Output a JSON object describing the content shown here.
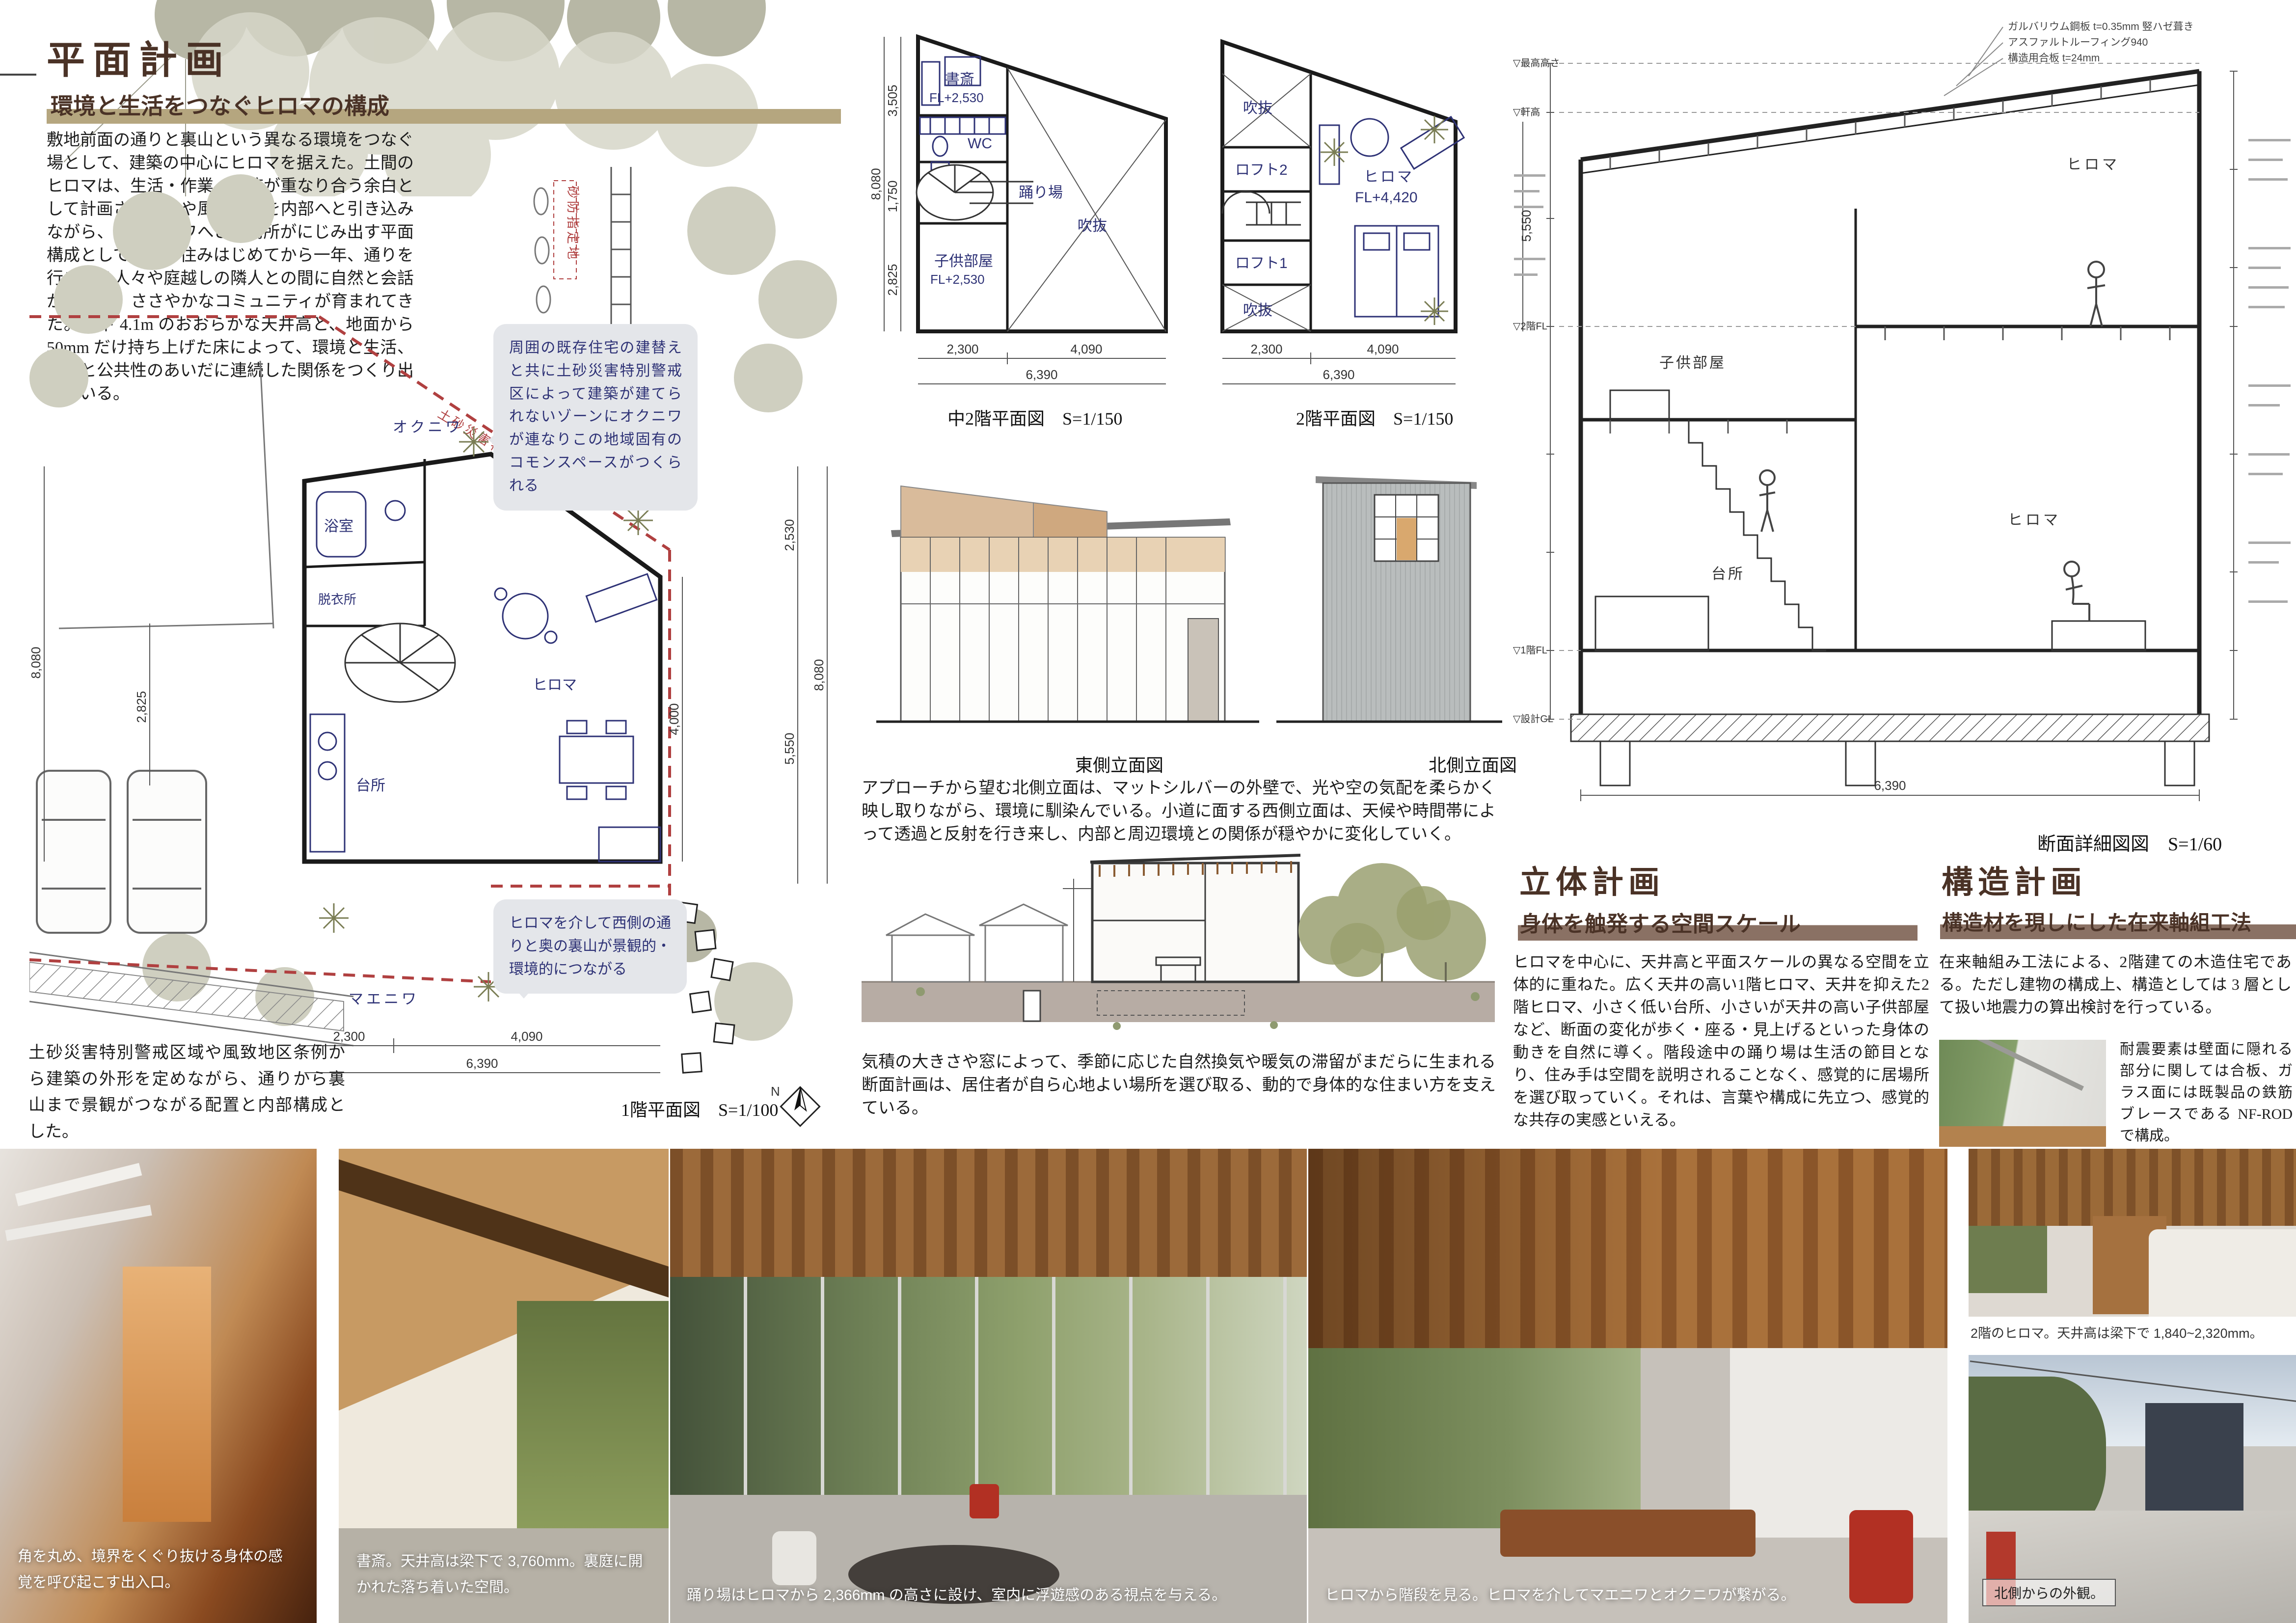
{
  "colors": {
    "accent_brown": "#4a3226",
    "tan_bar": "#b5a67f",
    "brown_bar": "#8a7164",
    "navy": "#2e3276",
    "hazard_red": "#b04040",
    "bubble_gray": "#e4e6ea"
  },
  "left": {
    "title": "平面計画",
    "subtitle": "環境と生活をつなぐヒロマの構成",
    "body": "敷地前面の通りと裏山という異なる環境をつなぐ場として、建築の中心にヒロマを据えた。土間のヒロマは、生活・作業・交流が重なり合う余白として計画され、光や風、気配を内部へと引き込みながら、東西のニワへと居場所がにじみ出す平面構成としている。住みはじめてから一年、通りを行き交う人々や庭越しの隣人との間に自然と会話が生まれ、ささやかなコミュニティが育まれてきた。梁下 4.1m のおおらかな天井高と、地面から 50mm だけ持ち上げた床によって、環境と生活、私性と公共性のあいだに連続した関係をつくり出している。",
    "callout_top": "周囲の既存住宅の建替えと共に土砂災害特別警戒区によって建築が建てられないゾーンにオクニワが連なりこの地域固有のコモンスペースがつくられる",
    "callout_bottom": "ヒロマを介して西側の通りと奥の裏山が景観的・環境的につながる",
    "note": "土砂災害特別警戒区域や風致地区条例から建築の外形を定めながら、通りから裏山まで景観がつながる配置と内部構成とした。",
    "plan_label": "1階平面図　S=1/100",
    "north_label": "N",
    "site": {
      "room_bath": "浴室",
      "room_dressing": "脱衣所",
      "room_hiroma": "ヒロマ",
      "room_kitchen": "台所",
      "garden_back": "オクニワ",
      "garden_front": "マエニワ",
      "hazard_line": "土砂災害特別警戒区域",
      "hazard_box": "砂防指定地",
      "dim_left_a": "8,080",
      "dim_left_b": "2,825",
      "dim_right_a": "2,530",
      "dim_right_b": "8,080",
      "dim_right_c": "5,550",
      "dim_right_d": "4,000",
      "dim_bottom_a": "2,300",
      "dim_bottom_b": "4,090",
      "dim_bottom_c": "6,390"
    }
  },
  "mid": {
    "plan_a": {
      "label": "中2階平面図　S=1/150",
      "study": "書斎",
      "study_fl": "FL+2,530",
      "wc": "WC",
      "landing": "踊り場",
      "void": "吹抜",
      "child": "子供部屋",
      "child_fl": "FL+2,530",
      "dim_v_total": "8,080",
      "dim_v1": "3,505",
      "dim_v2": "1,750",
      "dim_v3": "2,825",
      "dim_b1": "2,300",
      "dim_b2": "4,090",
      "dim_b_total": "6,390"
    },
    "plan_b": {
      "label": "2階平面図　S=1/150",
      "void_top": "吹抜",
      "loft2": "ロフト2",
      "loft1": "ロフト1",
      "void_bottom": "吹抜",
      "hiroma": "ヒロマ",
      "hiroma_fl": "FL+4,420",
      "dim_right": "5,550",
      "dim_b1": "2,300",
      "dim_b2": "4,090",
      "dim_b_total": "6,390"
    },
    "elev_east": "東側立面図",
    "elev_north": "北側立面図",
    "elev_text": "アプローチから望む北側立面は、マットシルバーの外壁で、光や空の気配を柔らかく映し取りながら、環境に馴染んでいる。小道に面する西側立面は、天候や時間帯によって透過と反射を行き来し、内部と周辺環境との関係が穏やかに変化していく。",
    "section_text": "気積の大きさや窓によって、季節に応じた自然換気や暖気の滞留がまだらに生まれる断面計画は、居住者が自ら心地よい場所を選び取る、動的で身体的な住まい方を支えている。"
  },
  "right": {
    "detail_label": "断面詳細図図　S=1/60",
    "room_hiroma_2f": "ヒロマ",
    "room_child": "子供部屋",
    "room_hiroma_1f": "ヒロマ",
    "room_kitchen": "台所",
    "lv_top": "▽最高高さ",
    "lv_eave": "▽軒高",
    "lv_2f": "▽2階FL",
    "lv_1f": "▽1階FL",
    "lv_gl": "▽設計GL",
    "ann_1": "ガルバリウム鋼板 t=0.35mm 竪ハゼ葺き",
    "ann_2": "アスファルトルーフィング940",
    "ann_3": "構造用合板 t=24mm",
    "dim_bottom": "6,390",
    "solid_title": "立体計画",
    "solid_subtitle": "身体を触発する空間スケール",
    "solid_body": "ヒロマを中心に、天井高と平面スケールの異なる空間を立体的に重ねた。広く天井の高い1階ヒロマ、天井を抑えた2階ヒロマ、小さく低い台所、小さいが天井の高い子供部屋など、断面の変化が歩く・座る・見上げるといった身体の動きを自然に導く。階段途中の踊り場は生活の節目となり、住み手は空間を説明されることなく、感覚的に居場所を選び取っていく。それは、言葉や構成に先立つ、感覚的な共存の実感といえる。",
    "structure_title": "構造計画",
    "structure_subtitle": "構造材を現しにした在来軸組工法",
    "structure_body1": "在来軸組み工法による、2階建ての木造住宅である。ただし建物の構成上、構造としては 3 層として扱い地震力の算出検討を行っている。",
    "structure_body2": "耐震要素は壁面に隠れる部分に関しては合板、ガラス面には既製品の鉄筋ブレースである NF-ROD で構成。"
  },
  "photos": {
    "caption_1": "角を丸め、境界をくぐり抜ける身体の感覚を呼び起こす出入口。",
    "caption_2": "書斎。天井高は梁下で 3,760mm。裏庭に開かれた落ち着いた空間。",
    "caption_3": "踊り場はヒロマから 2,366mm の高さに設け、室内に浮遊感のある視点を与える。",
    "caption_4": "ヒロマから階段を見る。ヒロマを介してマエニワとオクニワが繋がる。",
    "caption_5": "2階のヒロマ。天井高は梁下で 1,840~2,320mm。",
    "caption_6": "北側からの外観。"
  }
}
